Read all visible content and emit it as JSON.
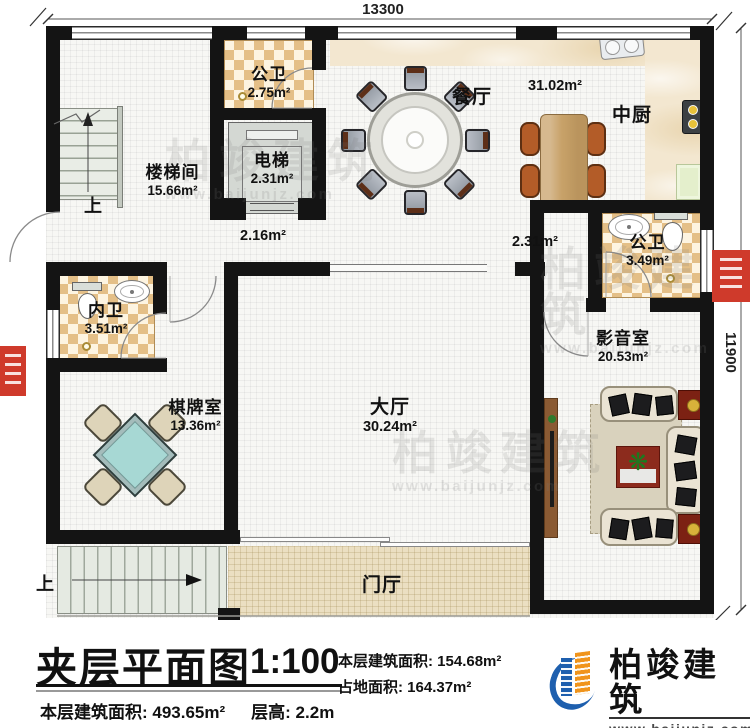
{
  "plan": {
    "dim_top": "13300",
    "dim_right": "11900",
    "up_label": "上",
    "rooms": [
      {
        "label": "楼梯间",
        "area": "15.66m²"
      },
      {
        "label": "公卫",
        "area": "2.75m²"
      },
      {
        "label": "电梯",
        "area": "2.31m²"
      },
      {
        "label": "餐厅",
        "area": "31.02m²"
      },
      {
        "label": "中厨",
        "area": ""
      },
      {
        "label": "公卫",
        "area": "3.49m²"
      },
      {
        "label": "内卫",
        "area": "3.51m²"
      },
      {
        "label": "棋牌室",
        "area": "13.36m²"
      },
      {
        "label": "大厅",
        "area": "30.24m²"
      },
      {
        "label": "影音室",
        "area": "20.53m²"
      },
      {
        "label": "门厅",
        "area": ""
      }
    ],
    "corridor_areas": [
      "2.16m²",
      "2.31m²"
    ]
  },
  "title_block": {
    "title": "夹层平面图",
    "scale": "1:100",
    "floor_area": "本层建筑面积: 154.68m²",
    "site_area": "占地面积: 164.37m²",
    "total_area": "本层建筑面积: 493.65m²",
    "floor_height": "层高: 2.2m"
  },
  "logo": {
    "name": "柏竣建筑",
    "url": "www.baijunjz.com"
  },
  "watermark": {
    "text": "柏竣建筑",
    "url": "www.baijunjz.com"
  }
}
